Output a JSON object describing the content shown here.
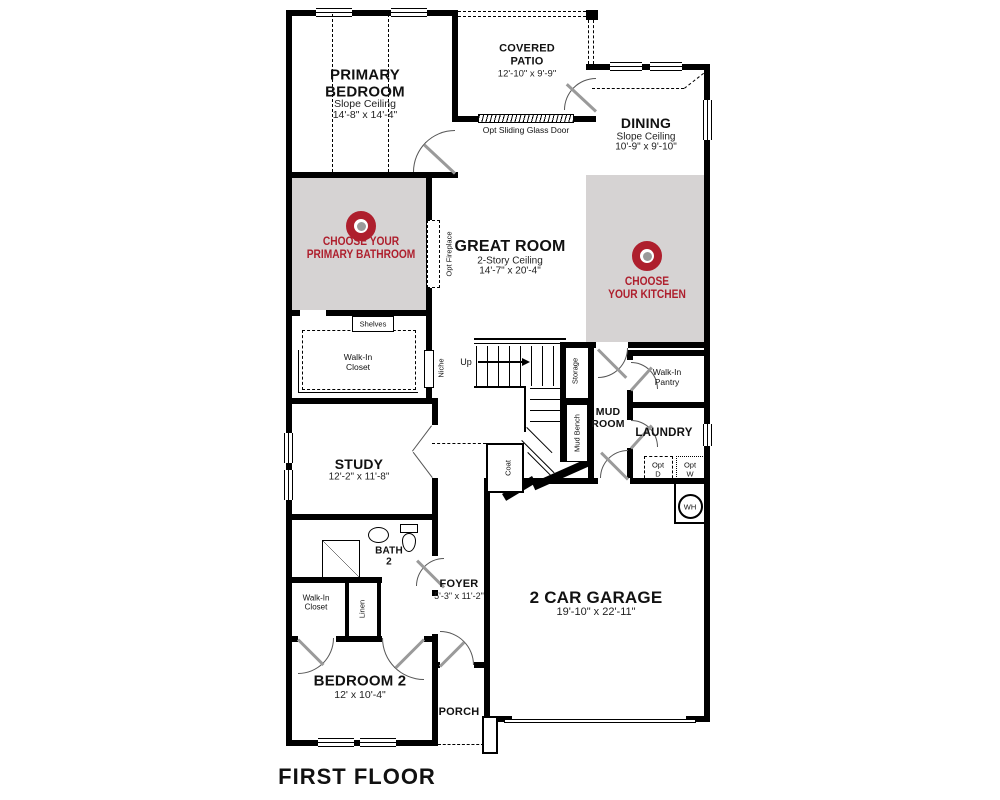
{
  "title": "FIRST FLOOR",
  "colors": {
    "wall": "#000000",
    "shade": "#d6d3d3",
    "accent": "#ae1f2d",
    "door_leaf": "#9a9a9a",
    "target_dot": "#9a9a9a"
  },
  "rooms": {
    "primary_bedroom": {
      "name": "PRIMARY BEDROOM",
      "ceiling": "Slope Ceiling",
      "dims": "14'-8\" x 14'-4\""
    },
    "covered_patio": {
      "name": "COVERED PATIO",
      "dims": "12'-10\" x 9'-9\""
    },
    "dining": {
      "name": "DINING",
      "ceiling": "Slope Ceiling",
      "dims": "10'-9\" x 9'-10\""
    },
    "great_room": {
      "name": "GREAT ROOM",
      "ceiling": "2-Story Ceiling",
      "dims": "14'-7\" x 20'-4\""
    },
    "study": {
      "name": "STUDY",
      "dims": "12'-2\" x 11'-8\""
    },
    "foyer": {
      "name": "FOYER",
      "dims": "5'-3\" x 11'-2\""
    },
    "garage": {
      "name": "2 CAR GARAGE",
      "dims": "19'-10\" x 22'-11\""
    },
    "bedroom_2": {
      "name": "BEDROOM 2",
      "dims": "12' x 10'-4\""
    },
    "porch": {
      "name": "PORCH"
    },
    "mud_room": {
      "line1": "MUD",
      "line2": "ROOM"
    },
    "laundry": {
      "name": "LAUNDRY"
    },
    "walk_in_pantry": {
      "line1": "Walk-In",
      "line2": "Pantry"
    },
    "bath_2": {
      "line1": "BATH",
      "line2": "2"
    },
    "primary_closet": {
      "line1": "Walk-In",
      "line2": "Closet"
    },
    "bedroom2_closet": {
      "line1": "Walk-In",
      "line2": "Closet"
    }
  },
  "badges": {
    "primary_bathroom": {
      "line1": "CHOOSE YOUR",
      "line2": "PRIMARY BATHROOM"
    },
    "kitchen": {
      "line1": "CHOOSE",
      "line2": "YOUR KITCHEN"
    }
  },
  "annotations": {
    "shelves": "Shelves",
    "niche": "Niche",
    "opt_fireplace": "Opt Fireplace",
    "opt_sliding_glass_door": "Opt Sliding Glass Door",
    "storage": "Storage",
    "mud_bench": "Mud Bench",
    "coat": "Coat",
    "linen": "Linen",
    "up": "Up",
    "water_heater": "WH",
    "opt_dryer": {
      "line1": "Opt",
      "line2": "D"
    },
    "opt_washer": {
      "line1": "Opt",
      "line2": "W"
    }
  }
}
